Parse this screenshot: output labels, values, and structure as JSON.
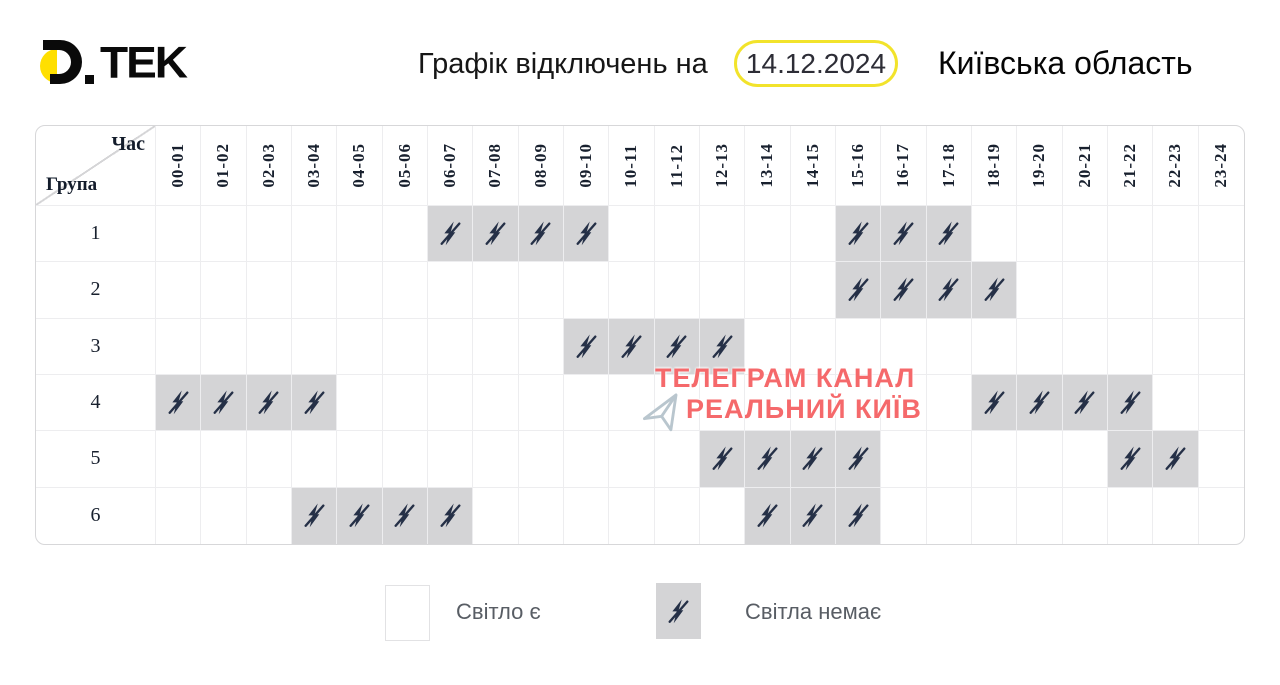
{
  "header": {
    "logo_text": "TEK",
    "title": "Графік відключень на",
    "date": "14.12.2024",
    "region": "Київська область"
  },
  "table": {
    "corner_time": "Час",
    "corner_group": "Група"
  },
  "chart_data": {
    "type": "heatmap",
    "title": "Графік відключень на 14.12.2024",
    "region": "Київська область",
    "x_label": "Час",
    "y_label": "Група",
    "x_categories": [
      "00-01",
      "01-02",
      "02-03",
      "03-04",
      "04-05",
      "05-06",
      "06-07",
      "07-08",
      "08-09",
      "09-10",
      "10-11",
      "11-12",
      "12-13",
      "13-14",
      "14-15",
      "15-16",
      "16-17",
      "17-18",
      "18-19",
      "19-20",
      "20-21",
      "21-22",
      "22-23",
      "23-24"
    ],
    "y_categories": [
      "1",
      "2",
      "3",
      "4",
      "5",
      "6"
    ],
    "legend": {
      "on": "Світло є",
      "off": "Світла немає"
    },
    "off_hours": {
      "1": [
        "06-07",
        "07-08",
        "08-09",
        "09-10",
        "15-16",
        "16-17",
        "17-18"
      ],
      "2": [
        "15-16",
        "16-17",
        "17-18",
        "18-19"
      ],
      "3": [
        "09-10",
        "10-11",
        "11-12",
        "12-13"
      ],
      "4": [
        "00-01",
        "01-02",
        "02-03",
        "03-04",
        "18-19",
        "19-20",
        "20-21",
        "21-22"
      ],
      "5": [
        "12-13",
        "13-14",
        "14-15",
        "15-16",
        "21-22",
        "22-23"
      ],
      "6": [
        "03-04",
        "04-05",
        "05-06",
        "06-07",
        "13-14",
        "14-15",
        "15-16"
      ]
    }
  },
  "watermark": {
    "line1": "ТЕЛЕГРАМ КАНАЛ",
    "line2": "РЕАЛЬНИЙ КИЇВ"
  },
  "colors": {
    "accent_yellow": "#f2e32b",
    "logo_yellow": "#ffdf00",
    "off_cell_gray": "#d4d4d6",
    "icon_navy": "#253047",
    "watermark_red": "#f5696b"
  }
}
